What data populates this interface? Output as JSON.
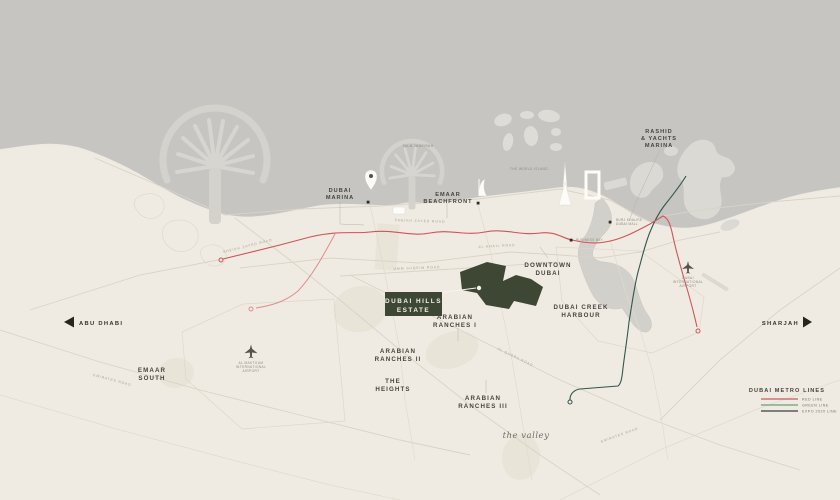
{
  "labels": {
    "palm_jumeirah": "PALM JUMEIRAH",
    "world_islands": "THE WORLD ISLAND",
    "dubai_marina": [
      "DUBAI",
      "MARINA"
    ],
    "emaar_beachfront": [
      "EMAAR",
      "BEACHFRONT"
    ],
    "rashid_marina": [
      "RASHID",
      "& YACHTS",
      "MARINA"
    ],
    "downtown_dubai": [
      "DOWNTOWN",
      "DUBAI"
    ],
    "dubai_creek_harbour": [
      "DUBAI CREEK",
      "HARBOUR"
    ],
    "dubai_hills_estate": [
      "DUBAI HILLS",
      "ESTATE"
    ],
    "arabian_ranches_1": [
      "ARABIAN",
      "RANCHES I"
    ],
    "arabian_ranches_2": [
      "ARABIAN",
      "RANCHES II"
    ],
    "arabian_ranches_3": [
      "ARABIAN",
      "RANCHES III"
    ],
    "the_heights": [
      "THE",
      "HEIGHTS"
    ],
    "the_valley": "the valley",
    "emaar_south": [
      "EMAAR",
      "SOUTH"
    ],
    "abu_dhabi": "ABU DHABI",
    "sharjah": "SHARJAH",
    "dubai_intl_airport": [
      "DUBAI",
      "INTERNATIONAL",
      "AIRPORT"
    ],
    "al_maktoum_airport": [
      "AL MAKTOUM",
      "INTERNATIONAL",
      "AIRPORT"
    ]
  },
  "stations": {
    "burj_khalifa": [
      "BURJ KHALIFA",
      "DUBAI MALL"
    ],
    "business_bay": "BUSINESS BAY"
  },
  "roads": {
    "sheikh_zayed_1": "SHEIKH ZAYED ROAD",
    "sheikh_zayed_2": "SHEIKH ZAYED ROAD",
    "al_khail": "AL KHAIL ROAD",
    "umm_suqeim": "UMM SUQEIM ROAD",
    "al_qudra": "AL QUDRA ROAD",
    "emirates_road": "EMIRATES ROAD",
    "emirates_road_2": "EMIRATES ROAD"
  },
  "legend": {
    "title": "DUBAI METRO LINES",
    "items": [
      {
        "label": "RED LINE",
        "color": "#d2545c"
      },
      {
        "label": "GREEN LINE",
        "color": "#6f9d7d"
      },
      {
        "label": "EXPO 2020 LINE",
        "color": "#3a3f3c"
      }
    ]
  },
  "colors": {
    "sea": "#c6c5c1",
    "land": "#f0ebe2",
    "estate_green": "#3d4733",
    "metro_red": "#d0545a",
    "metro_green": "#2f564c"
  }
}
